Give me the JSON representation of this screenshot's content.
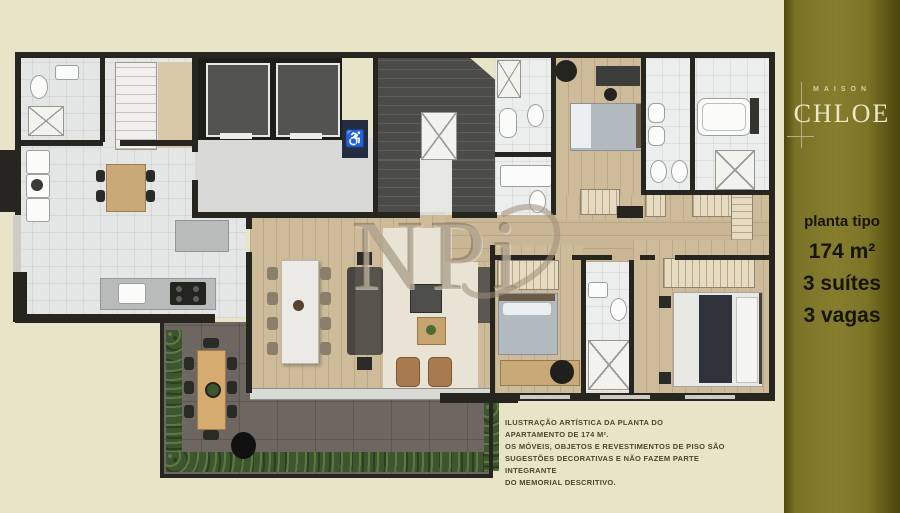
{
  "brand": {
    "label": "MAISON",
    "name": "CHLOE"
  },
  "panel": {
    "plan_type": "planta tipo",
    "area": "174 m²",
    "suites": "3 suítes",
    "parking": "3 vagas"
  },
  "watermark": {
    "text": "NPi"
  },
  "icons": {
    "wheelchair": "♿"
  },
  "disclaimer": {
    "lines": [
      "ILUSTRAÇÃO ARTÍSTICA DA PLANTA DO APARTAMENTO DE 174 M².",
      "OS MÓVEIS, OBJETOS E REVESTIMENTOS DE PISO SÃO",
      "SUGESTÕES DECORATIVAS E NÃO FAZEM PARTE INTEGRANTE",
      "DO MEMORIAL DESCRITIVO."
    ]
  },
  "colors": {
    "background_cream": "#e8e4c8",
    "panel_olive": "#867e2e",
    "panel_olive_edge": "#4a440a",
    "logo_text": "#ece8c8",
    "spec_text": "#16140b",
    "wall": "#26251f",
    "wood_floor": "#cdbb9a",
    "tile_floor": "#e4e6e6",
    "terrace_floor": "#6e6761",
    "hedge_green": "#3f5530",
    "elevator_shaft": "#535351",
    "stair_gray": "#4b4b49",
    "accessibility_sign": "#232c40",
    "sofa_gray": "#474540",
    "bed_blanket": "#b2bac0",
    "master_duvet": "#30323a",
    "armchair": "#a87a50",
    "watermark": "#9e8e78",
    "disclaimer_text": "#4c462f"
  }
}
